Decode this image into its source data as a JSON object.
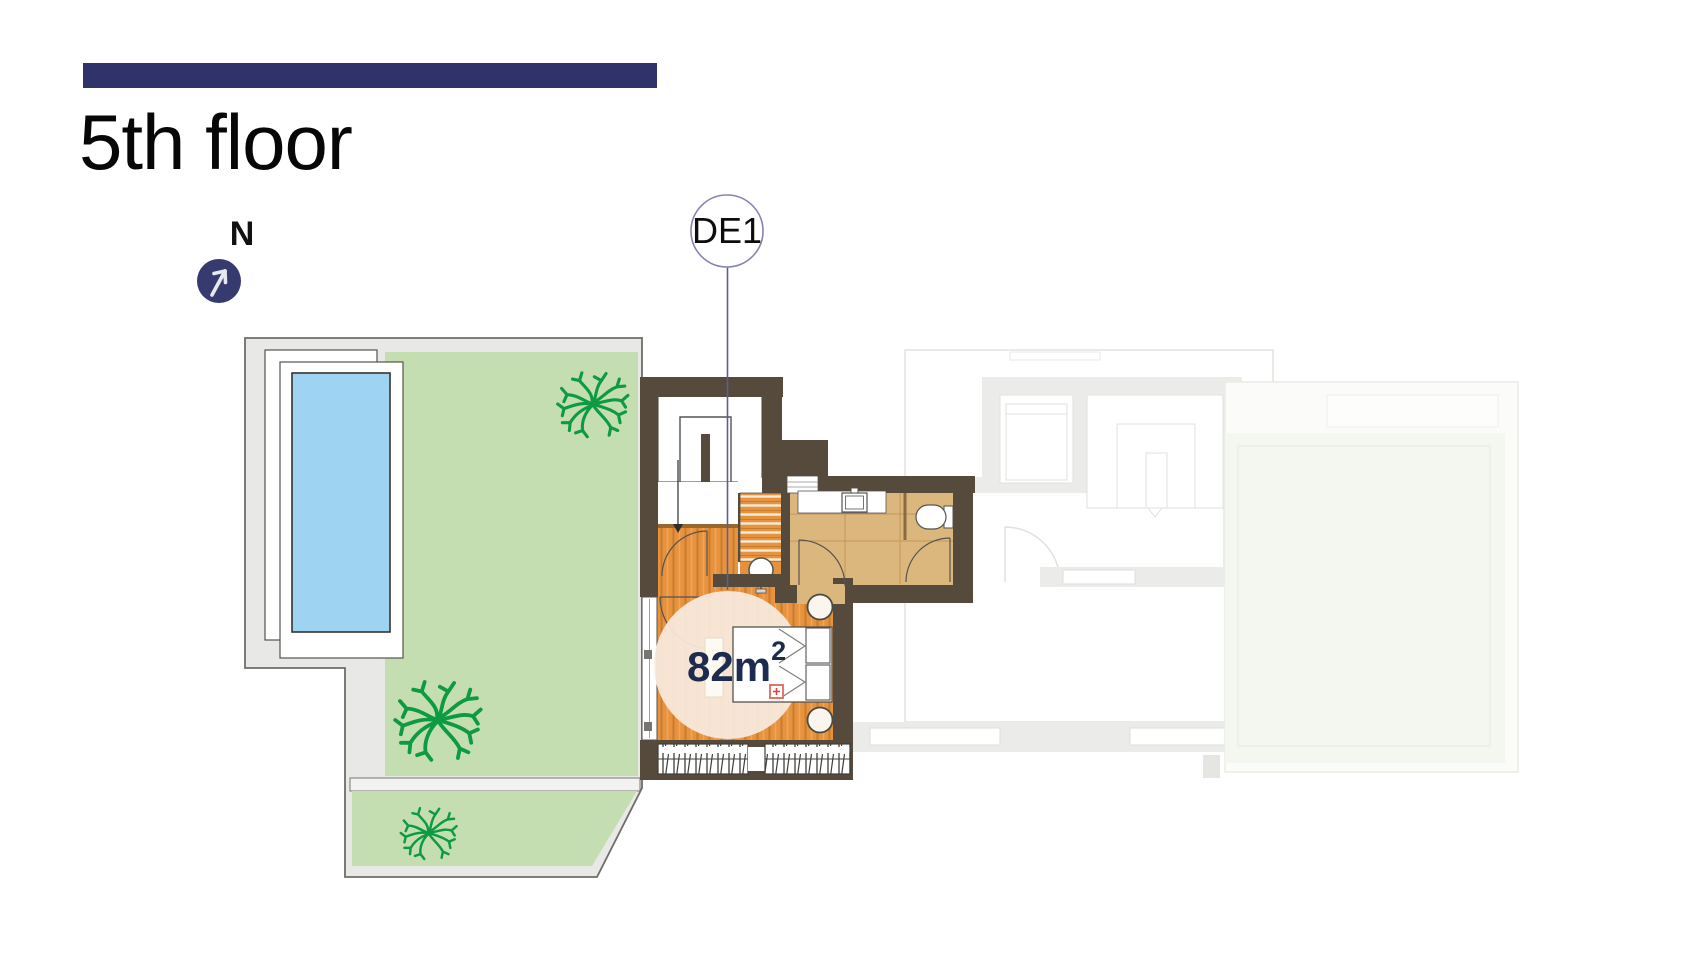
{
  "header": {
    "title": "5th floor"
  },
  "north": {
    "label": "N"
  },
  "unit": {
    "label": "DE1",
    "area_value": "82m",
    "area_exponent": "2",
    "area_full": "82m²"
  },
  "floorplan": {
    "highlighted_unit": "DE1",
    "features": [
      "swimming-pool",
      "garden-terrace",
      "trees",
      "stairwell",
      "staircase",
      "bathroom",
      "toilet",
      "sink",
      "bedroom",
      "double-bed",
      "nightstands",
      "wardrobe",
      "faded-neighbor-unit",
      "neighbor-terrace"
    ]
  },
  "colors": {
    "accent_navy": "#30336a",
    "north_circle": "#363a6e",
    "badge_stroke": "#8585ad",
    "leader_line": "#5d5d90",
    "area_text": "#1c2b4e",
    "wall_brown": "#564a3c",
    "wood_floor": "#e6923e",
    "bath_tile": "#dcb77d",
    "garden_green": "#c5deb1",
    "pool_blue": "#9fd3f2",
    "tree_green": "#0d9b42",
    "highlight_circle": "#f9ecdf",
    "faint_plan": "#ebebe9",
    "faint_terrace": "#f3f7ef"
  }
}
